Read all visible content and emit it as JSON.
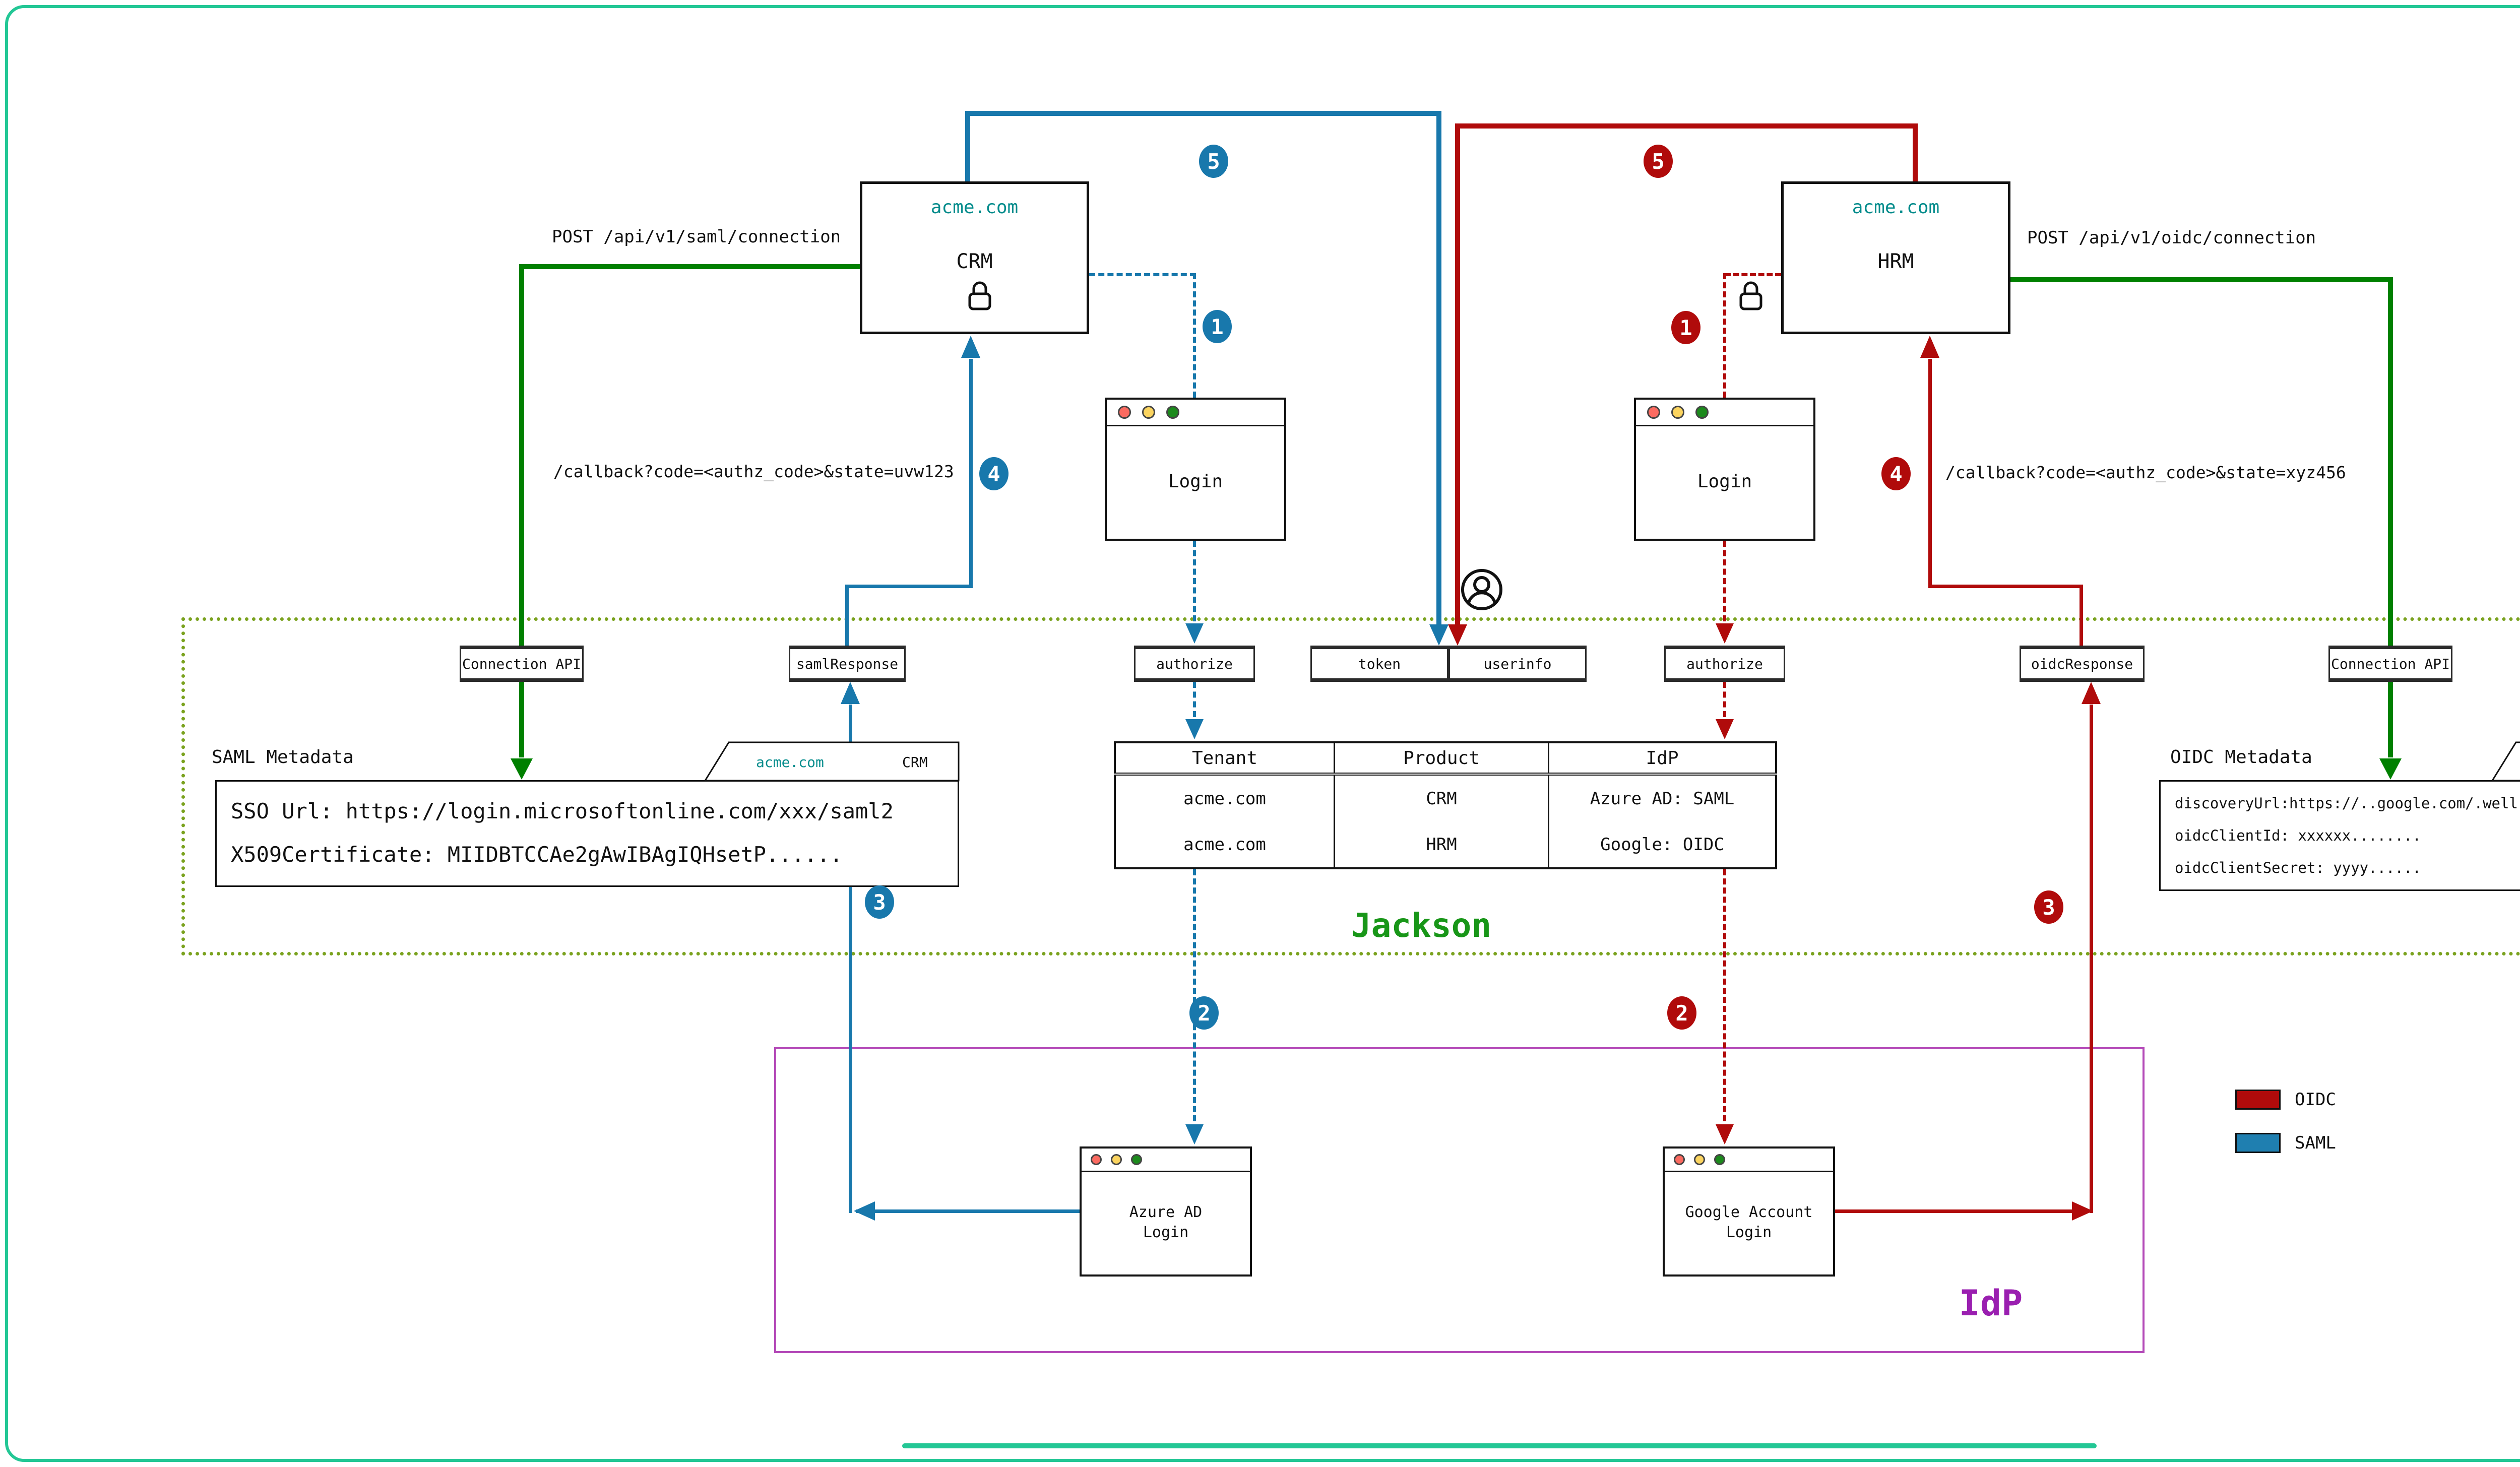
{
  "flows": {
    "saml": {
      "color": "#1878ac"
    },
    "oidc": {
      "color": "#b00b0b"
    },
    "api": {
      "color": "#008000"
    }
  },
  "crm_app": {
    "domain": "acme.com",
    "name": "CRM"
  },
  "hrm_app": {
    "domain": "acme.com",
    "name": "HRM"
  },
  "post_saml": "POST /api/v1/saml/connection",
  "post_oidc": "POST /api/v1/oidc/connection",
  "callback_saml": "/callback?code=<authz_code>&state=uvw123",
  "callback_oidc": "/callback?code=<authz_code>&state=xyz456",
  "login_window": {
    "title": "Login"
  },
  "jackson": {
    "label": "Jackson",
    "connection_api_left": "Connection API",
    "saml_response": "samlResponse",
    "authorize_left": "authorize",
    "token": "token",
    "userinfo": "userinfo",
    "authorize_right": "authorize",
    "oidc_response": "oidcResponse",
    "connection_api_right": "Connection API"
  },
  "saml_metadata": {
    "title": "SAML Metadata",
    "tab": {
      "domain": "acme.com",
      "product": "CRM"
    },
    "line1": "SSO Url: https://login.microsoftonline.com/xxx/saml2",
    "line2": "X509Certificate: MIIDBTCCAe2gAwIBAgIQHsetP......"
  },
  "oidc_metadata": {
    "title": "OIDC Metadata",
    "tab": {
      "domain": "acme.com",
      "product": "HRM"
    },
    "line1": "discoveryUrl:https://..google.com/.well-known/openid-configuration",
    "line2": "oidcClientId: xxxxxx........",
    "line3": "oidcClientSecret: yyyy......"
  },
  "connections_table": {
    "headers": [
      "Tenant",
      "Product",
      "IdP"
    ],
    "rows": [
      [
        "acme.com",
        "CRM",
        "Azure AD: SAML"
      ],
      [
        "acme.com",
        "HRM",
        "Google: OIDC"
      ]
    ]
  },
  "idp": {
    "label": "IdP",
    "azure_line1": "Azure AD",
    "azure_line2": "Login",
    "google_line1": "Google Account",
    "google_line2": "Login"
  },
  "steps": {
    "s1": "1",
    "s2": "2",
    "s3": "3",
    "s4": "4",
    "s5": "5"
  },
  "legend": {
    "oidc": "OIDC",
    "saml": "SAML"
  }
}
